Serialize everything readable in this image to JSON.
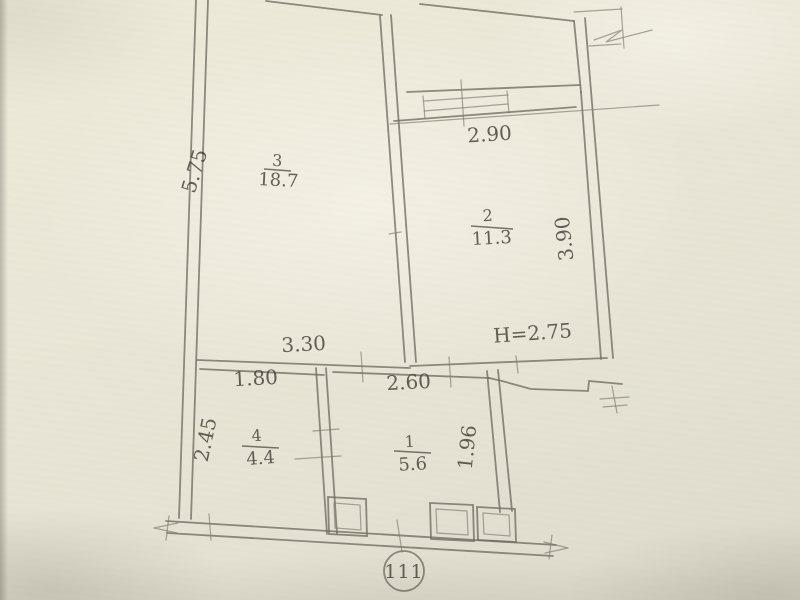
{
  "floor_plan": {
    "unit_number": "111",
    "rooms": [
      {
        "number": "3",
        "area": "18.7"
      },
      {
        "number": "2",
        "area": "11.3"
      },
      {
        "number": "4",
        "area": "4.4"
      },
      {
        "number": "1",
        "area": "5.6"
      }
    ],
    "dimensions": {
      "left_height": "5.75",
      "balcony_width": "2.90",
      "right_height": "3.90",
      "hall_width": "3.30",
      "room4_width": "1.80",
      "room1_width": "2.60",
      "room4_depth": "2.45",
      "room1_depth": "1.96",
      "ceiling_height": "H=2.75"
    }
  }
}
